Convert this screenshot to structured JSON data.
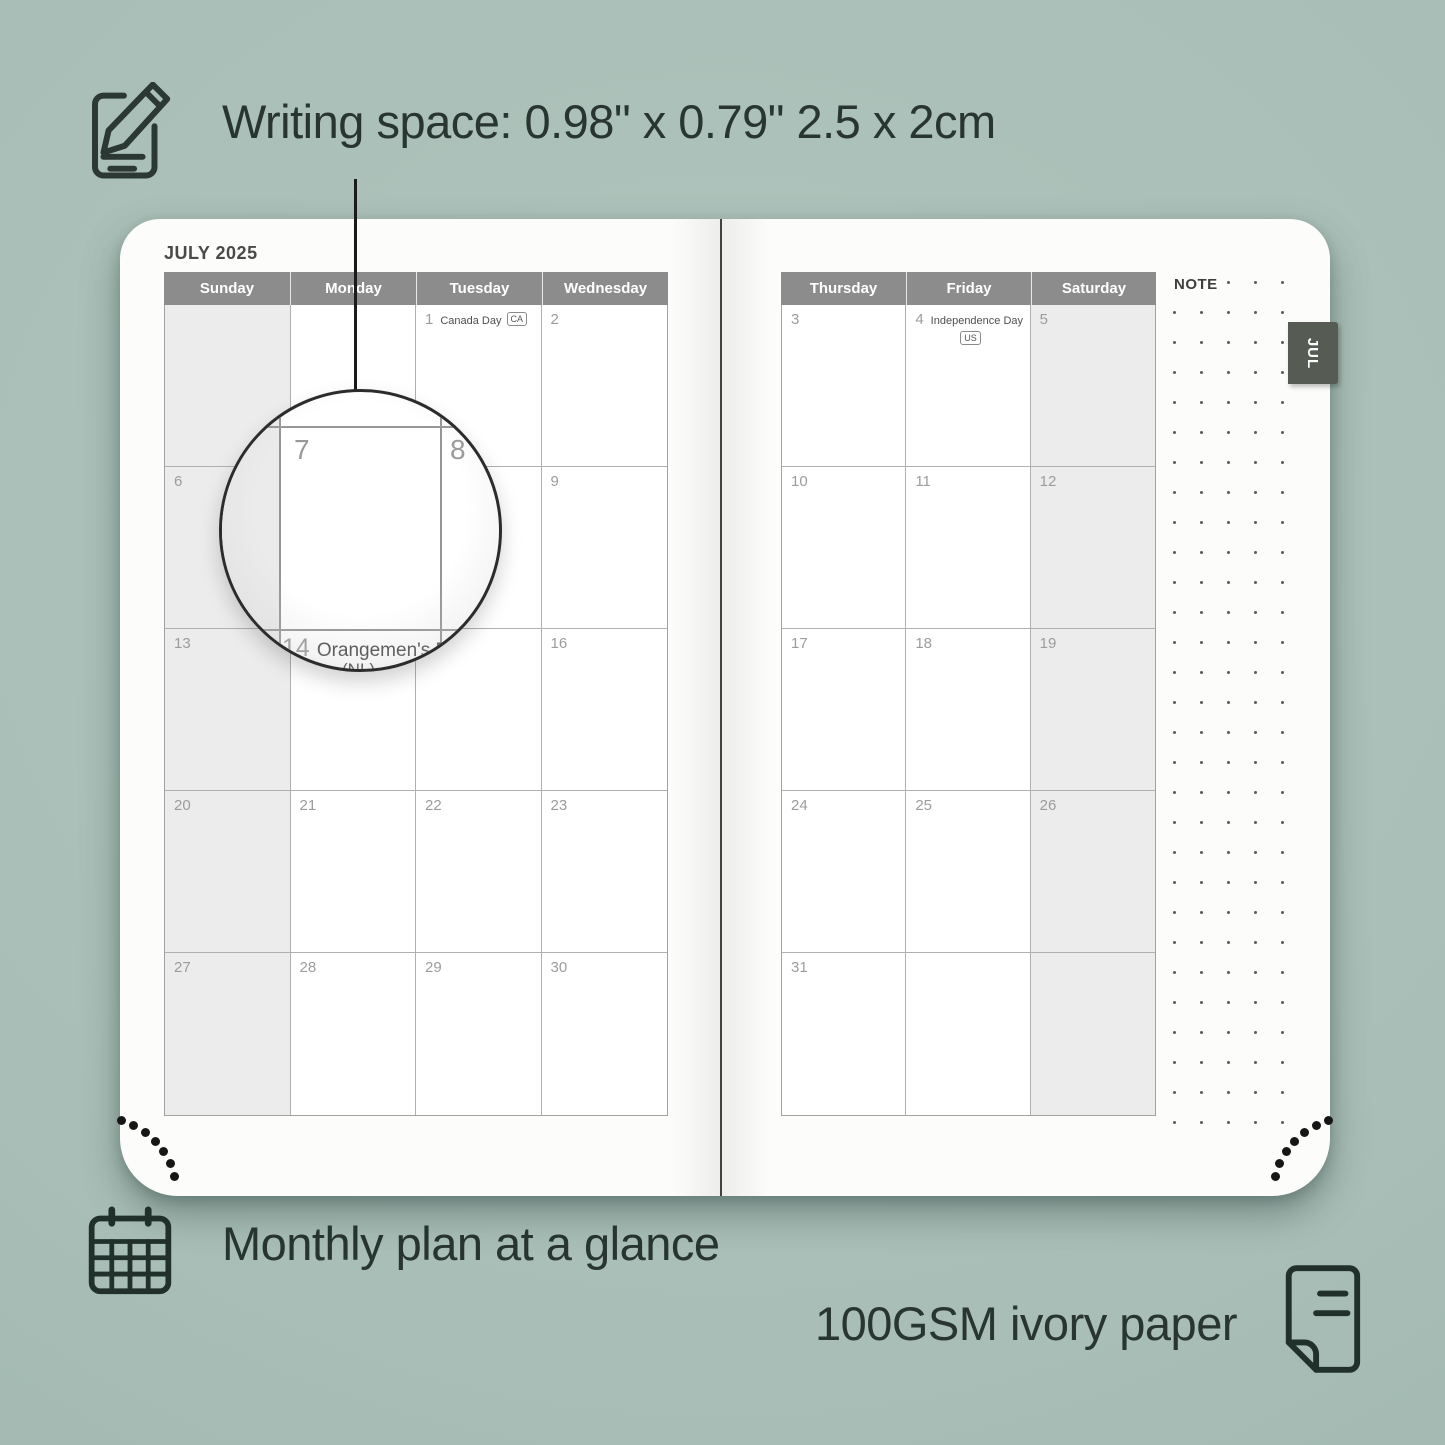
{
  "annotations": {
    "writing_space": "Writing space: 0.98\" x 0.79\" 2.5 x 2cm",
    "monthly_plan": "Monthly plan at a glance",
    "paper": "100GSM ivory paper"
  },
  "planner": {
    "month_title": "JULY 2025",
    "tab_label": "JUL",
    "note_label": "NOTE",
    "left_page": {
      "day_headers": [
        "Sunday",
        "Monday",
        "Tuesday",
        "Wednesday"
      ],
      "weeks": [
        [
          {
            "day": "",
            "shaded": true
          },
          {
            "day": ""
          },
          {
            "day": "1",
            "holiday": "Canada Day",
            "badge": "CA"
          },
          {
            "day": "2"
          }
        ],
        [
          {
            "day": "6",
            "shaded": true
          },
          {
            "day": "7"
          },
          {
            "day": "8"
          },
          {
            "day": "9"
          }
        ],
        [
          {
            "day": "13",
            "shaded": true
          },
          {
            "day": ""
          },
          {
            "day": ""
          },
          {
            "day": "16"
          }
        ],
        [
          {
            "day": "20",
            "shaded": true
          },
          {
            "day": "21"
          },
          {
            "day": "22"
          },
          {
            "day": "23"
          }
        ],
        [
          {
            "day": "27",
            "shaded": true
          },
          {
            "day": "28"
          },
          {
            "day": "29"
          },
          {
            "day": "30"
          }
        ]
      ]
    },
    "right_page": {
      "day_headers": [
        "Thursday",
        "Friday",
        "Saturday"
      ],
      "weeks": [
        [
          {
            "day": "3"
          },
          {
            "day": "4",
            "holiday": "Independence Day",
            "badge": "US",
            "badge_below": true
          },
          {
            "day": "5",
            "shaded": true
          }
        ],
        [
          {
            "day": "10"
          },
          {
            "day": "11"
          },
          {
            "day": "12",
            "shaded": true
          }
        ],
        [
          {
            "day": "17"
          },
          {
            "day": "18"
          },
          {
            "day": "19",
            "shaded": true
          }
        ],
        [
          {
            "day": "24"
          },
          {
            "day": "25"
          },
          {
            "day": "26",
            "shaded": true
          }
        ],
        [
          {
            "day": "31"
          },
          {
            "day": ""
          },
          {
            "day": "",
            "shaded": true
          }
        ]
      ]
    },
    "magnifier": {
      "day_left": "7",
      "day_right": "8",
      "caption_day": "14",
      "caption": "Orangemen's Day",
      "caption2": "(NL)"
    }
  },
  "colors": {
    "background": "#a8beb6",
    "page": "#fcfcfb",
    "header_bg": "#8c8c8c",
    "header_text": "#ffffff",
    "weekend_shade": "#ececec",
    "grid_border": "#b0b0b0",
    "day_number": "#9c9c9c",
    "holiday_text": "#4f4f4f",
    "tab_bg": "#565b53",
    "ink": "#283531"
  },
  "decor": {
    "note_dot_grid": {
      "cols": 5,
      "rows": 29,
      "first_row_label_cols": 2
    },
    "corner_arc_dots": 7
  }
}
